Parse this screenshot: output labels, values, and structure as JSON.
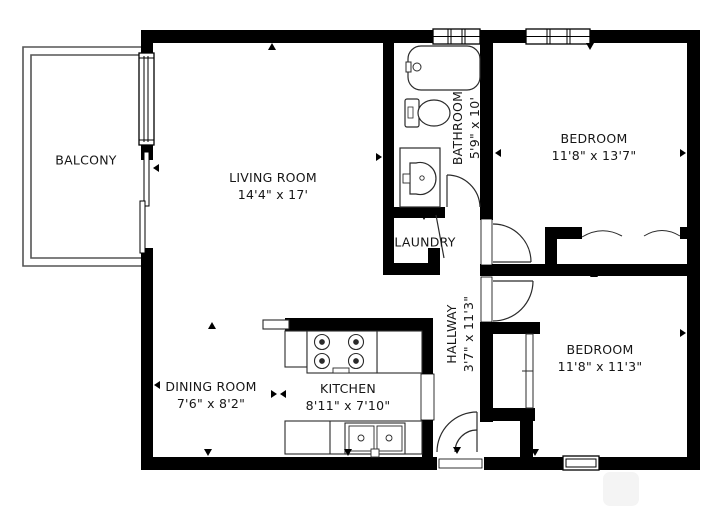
{
  "plan_type": "apartment-floor-plan",
  "rooms": {
    "balcony": {
      "name": "BALCONY"
    },
    "living_room": {
      "name": "LIVING ROOM",
      "dims": "14'4\" x 17'"
    },
    "bathroom": {
      "name": "BATHROOM",
      "dims": "5'9\" x 10'"
    },
    "bedroom_top": {
      "name": "BEDROOM",
      "dims": "11'8\" x 13'7\""
    },
    "laundry": {
      "name": "LAUNDRY"
    },
    "hallway": {
      "name": "HALLWAY",
      "dims": "3'7\" x 11'3\""
    },
    "kitchen": {
      "name": "KITCHEN",
      "dims": "8'11\" x 7'10\""
    },
    "dining_room": {
      "name": "DINING ROOM",
      "dims": "7'6\" x 8'2\""
    },
    "bedroom_bottom": {
      "name": "BEDROOM",
      "dims": "11'8\" x 11'3\""
    }
  },
  "colors": {
    "wall": "#000000",
    "background": "#ffffff",
    "fixture_line": "#2b2b2b"
  }
}
